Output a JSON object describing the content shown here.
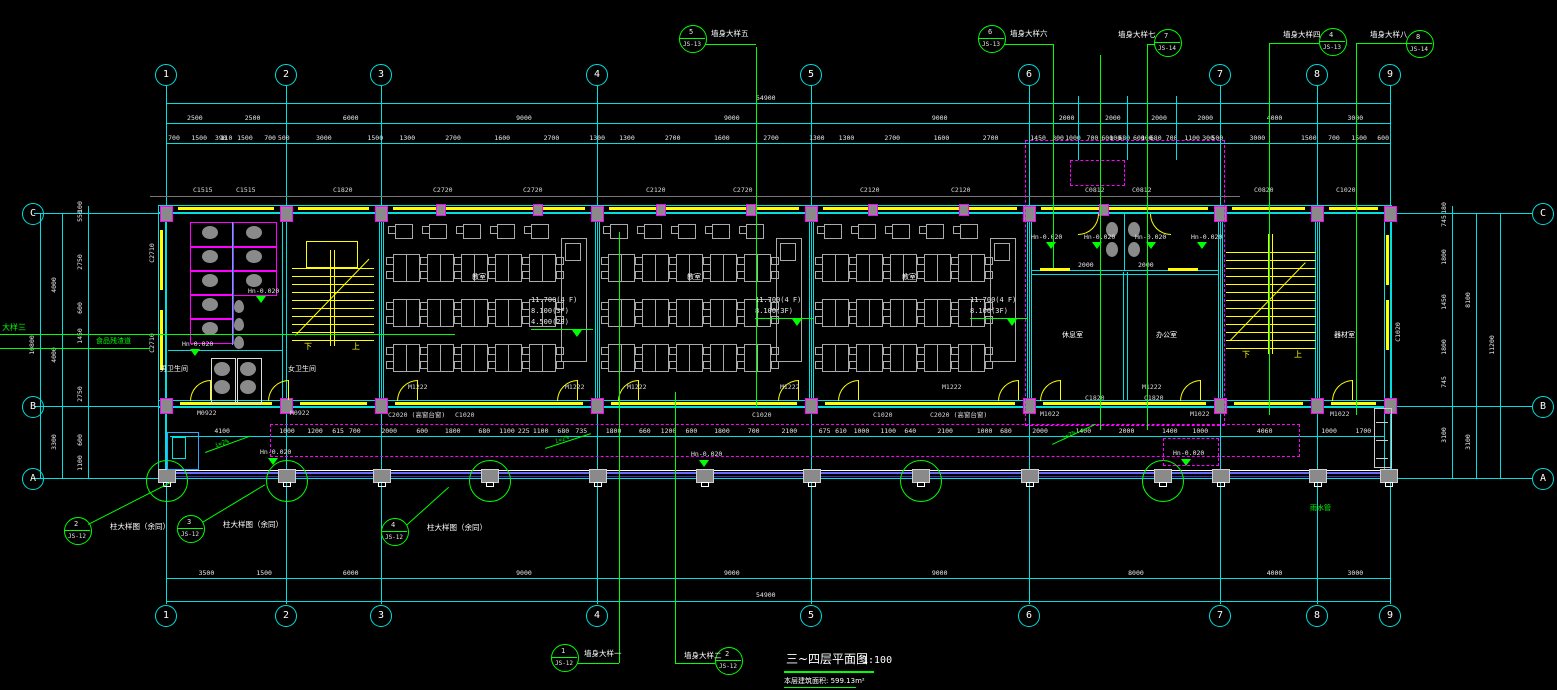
{
  "drawing": {
    "title": "三~四层平面图",
    "scale": "1:100",
    "area_note": "本层建筑面积: 599.13m²"
  },
  "colors": {
    "grid_line": "#00e0e0",
    "detail_callout": "#00ff00",
    "stair_wall": "#ffff00",
    "column_outline": "#ff00ff",
    "text": "#ffffff"
  },
  "grid": {
    "cols": [
      "1",
      "2",
      "3",
      "4",
      "5",
      "6",
      "7",
      "8",
      "9"
    ],
    "rows": [
      "C",
      "B",
      "A"
    ]
  },
  "dims": {
    "top_total": "54900",
    "bottom_total": "54900",
    "top_spans": [
      "2500",
      "2500",
      "6000",
      "9000",
      "9000",
      "9000",
      "2000",
      "2000",
      "2000",
      "2000",
      "4000",
      "3000"
    ],
    "top_detail": [
      "700",
      "1500",
      "390",
      "110",
      "1500",
      "700",
      "500",
      "3000",
      "1500",
      "1300",
      "2700",
      "1600",
      "2700",
      "1300",
      "1300",
      "2700",
      "1600",
      "2700",
      "1300",
      "1300",
      "2700",
      "1600",
      "2700",
      "1450",
      "300",
      "1000",
      "700",
      "600",
      "100",
      "680",
      "600",
      "100",
      "680",
      "700",
      "1100",
      "300",
      "500",
      "3000",
      "1500",
      "700",
      "1500",
      "600"
    ],
    "bottom_spans": [
      "3500",
      "1500",
      "6000",
      "9000",
      "9000",
      "9000",
      "8000",
      "4000",
      "3000"
    ],
    "corridor": [
      "4100",
      "1000",
      "1200",
      "615",
      "700",
      "2000",
      "600",
      "1800",
      "680",
      "1100",
      "225",
      "1100",
      "680",
      "735",
      "1800",
      "660",
      "1200",
      "600",
      "1800",
      "700",
      "2100",
      "675",
      "610",
      "1000",
      "1100",
      "640",
      "2100",
      "1000",
      "680",
      "2000",
      "1400",
      "2000",
      "1400",
      "1000",
      "4060",
      "1000",
      "1700"
    ],
    "left_outer": "10800",
    "left_mid": [
      "4000",
      "4000",
      "3300"
    ],
    "left_inner": [
      "100",
      "550",
      "2750",
      "600",
      "1450",
      "2750",
      "600",
      "1100"
    ],
    "right_outer": "11200",
    "right_mid": [
      "8100",
      "3100"
    ],
    "right_inner": [
      "180",
      "745",
      "1800",
      "1450",
      "1800",
      "745",
      "3100"
    ],
    "wc_right": [
      "2000",
      "2000"
    ]
  },
  "callouts": {
    "top": [
      {
        "num": "5",
        "ref": "JS-13",
        "label": "墙身大样五"
      },
      {
        "num": "6",
        "ref": "JS-13",
        "label": "墙身大样六"
      },
      {
        "num": "7",
        "ref": "JS-14",
        "label": "墙身大样七"
      },
      {
        "num": "4",
        "ref": "JS-13",
        "label": "墙身大样四"
      },
      {
        "num": "8",
        "ref": "JS-14",
        "label": "墙身大样八"
      }
    ],
    "wall_bottom": [
      {
        "num": "1",
        "ref": "JS-12",
        "label": "墙身大样一"
      },
      {
        "num": "2",
        "ref": "JS-12",
        "label": "墙身大样二"
      }
    ],
    "columns": [
      {
        "num": "2",
        "ref": "JS-12",
        "label": "柱大样图（余同）"
      },
      {
        "num": "3",
        "ref": "JS-12",
        "label": "柱大样图（余同）"
      },
      {
        "num": "4",
        "ref": "JS-12",
        "label": "柱大样图（余同）"
      }
    ]
  },
  "levels": {
    "full": [
      "11.700(4 F)",
      "8.100(3F)",
      "4.500(2F)"
    ],
    "upper": [
      "11.700(4 F)",
      "8.100(3F)"
    ]
  },
  "notes": {
    "floor_level": "Hn-0.020",
    "slope": "i=2%",
    "stair_down": "下",
    "stair_up": "上",
    "detail_three": "大样三",
    "chute": "食品残渣道",
    "rain_pipe": "雨水管"
  },
  "rooms": {
    "wc_male": "男卫生间",
    "wc_female": "女卫生间",
    "classroom": "教室",
    "rest": "休息室",
    "office": "办公室",
    "storage": "器材室"
  },
  "openings": {
    "top": [
      "C1515",
      "C1515",
      "C1820",
      "C2720",
      "C2720",
      "C2120",
      "C2720",
      "C2120",
      "C2120",
      "C0812",
      "C0812",
      "C0820",
      "C1020"
    ],
    "bottom": [
      "M0922",
      "M0922",
      "C2020 (高窗台窗)",
      "C1020",
      "C1020",
      "C1020",
      "C2020 (高窗台窗)",
      "C1820",
      "C1820",
      "M1022",
      "M1022",
      "M1022"
    ],
    "corridor_doors": [
      "M1222",
      "M1222",
      "M1222",
      "M1222",
      "M1222",
      "M1222"
    ],
    "west": [
      "C2710",
      "C2710"
    ],
    "east": "C1020"
  }
}
